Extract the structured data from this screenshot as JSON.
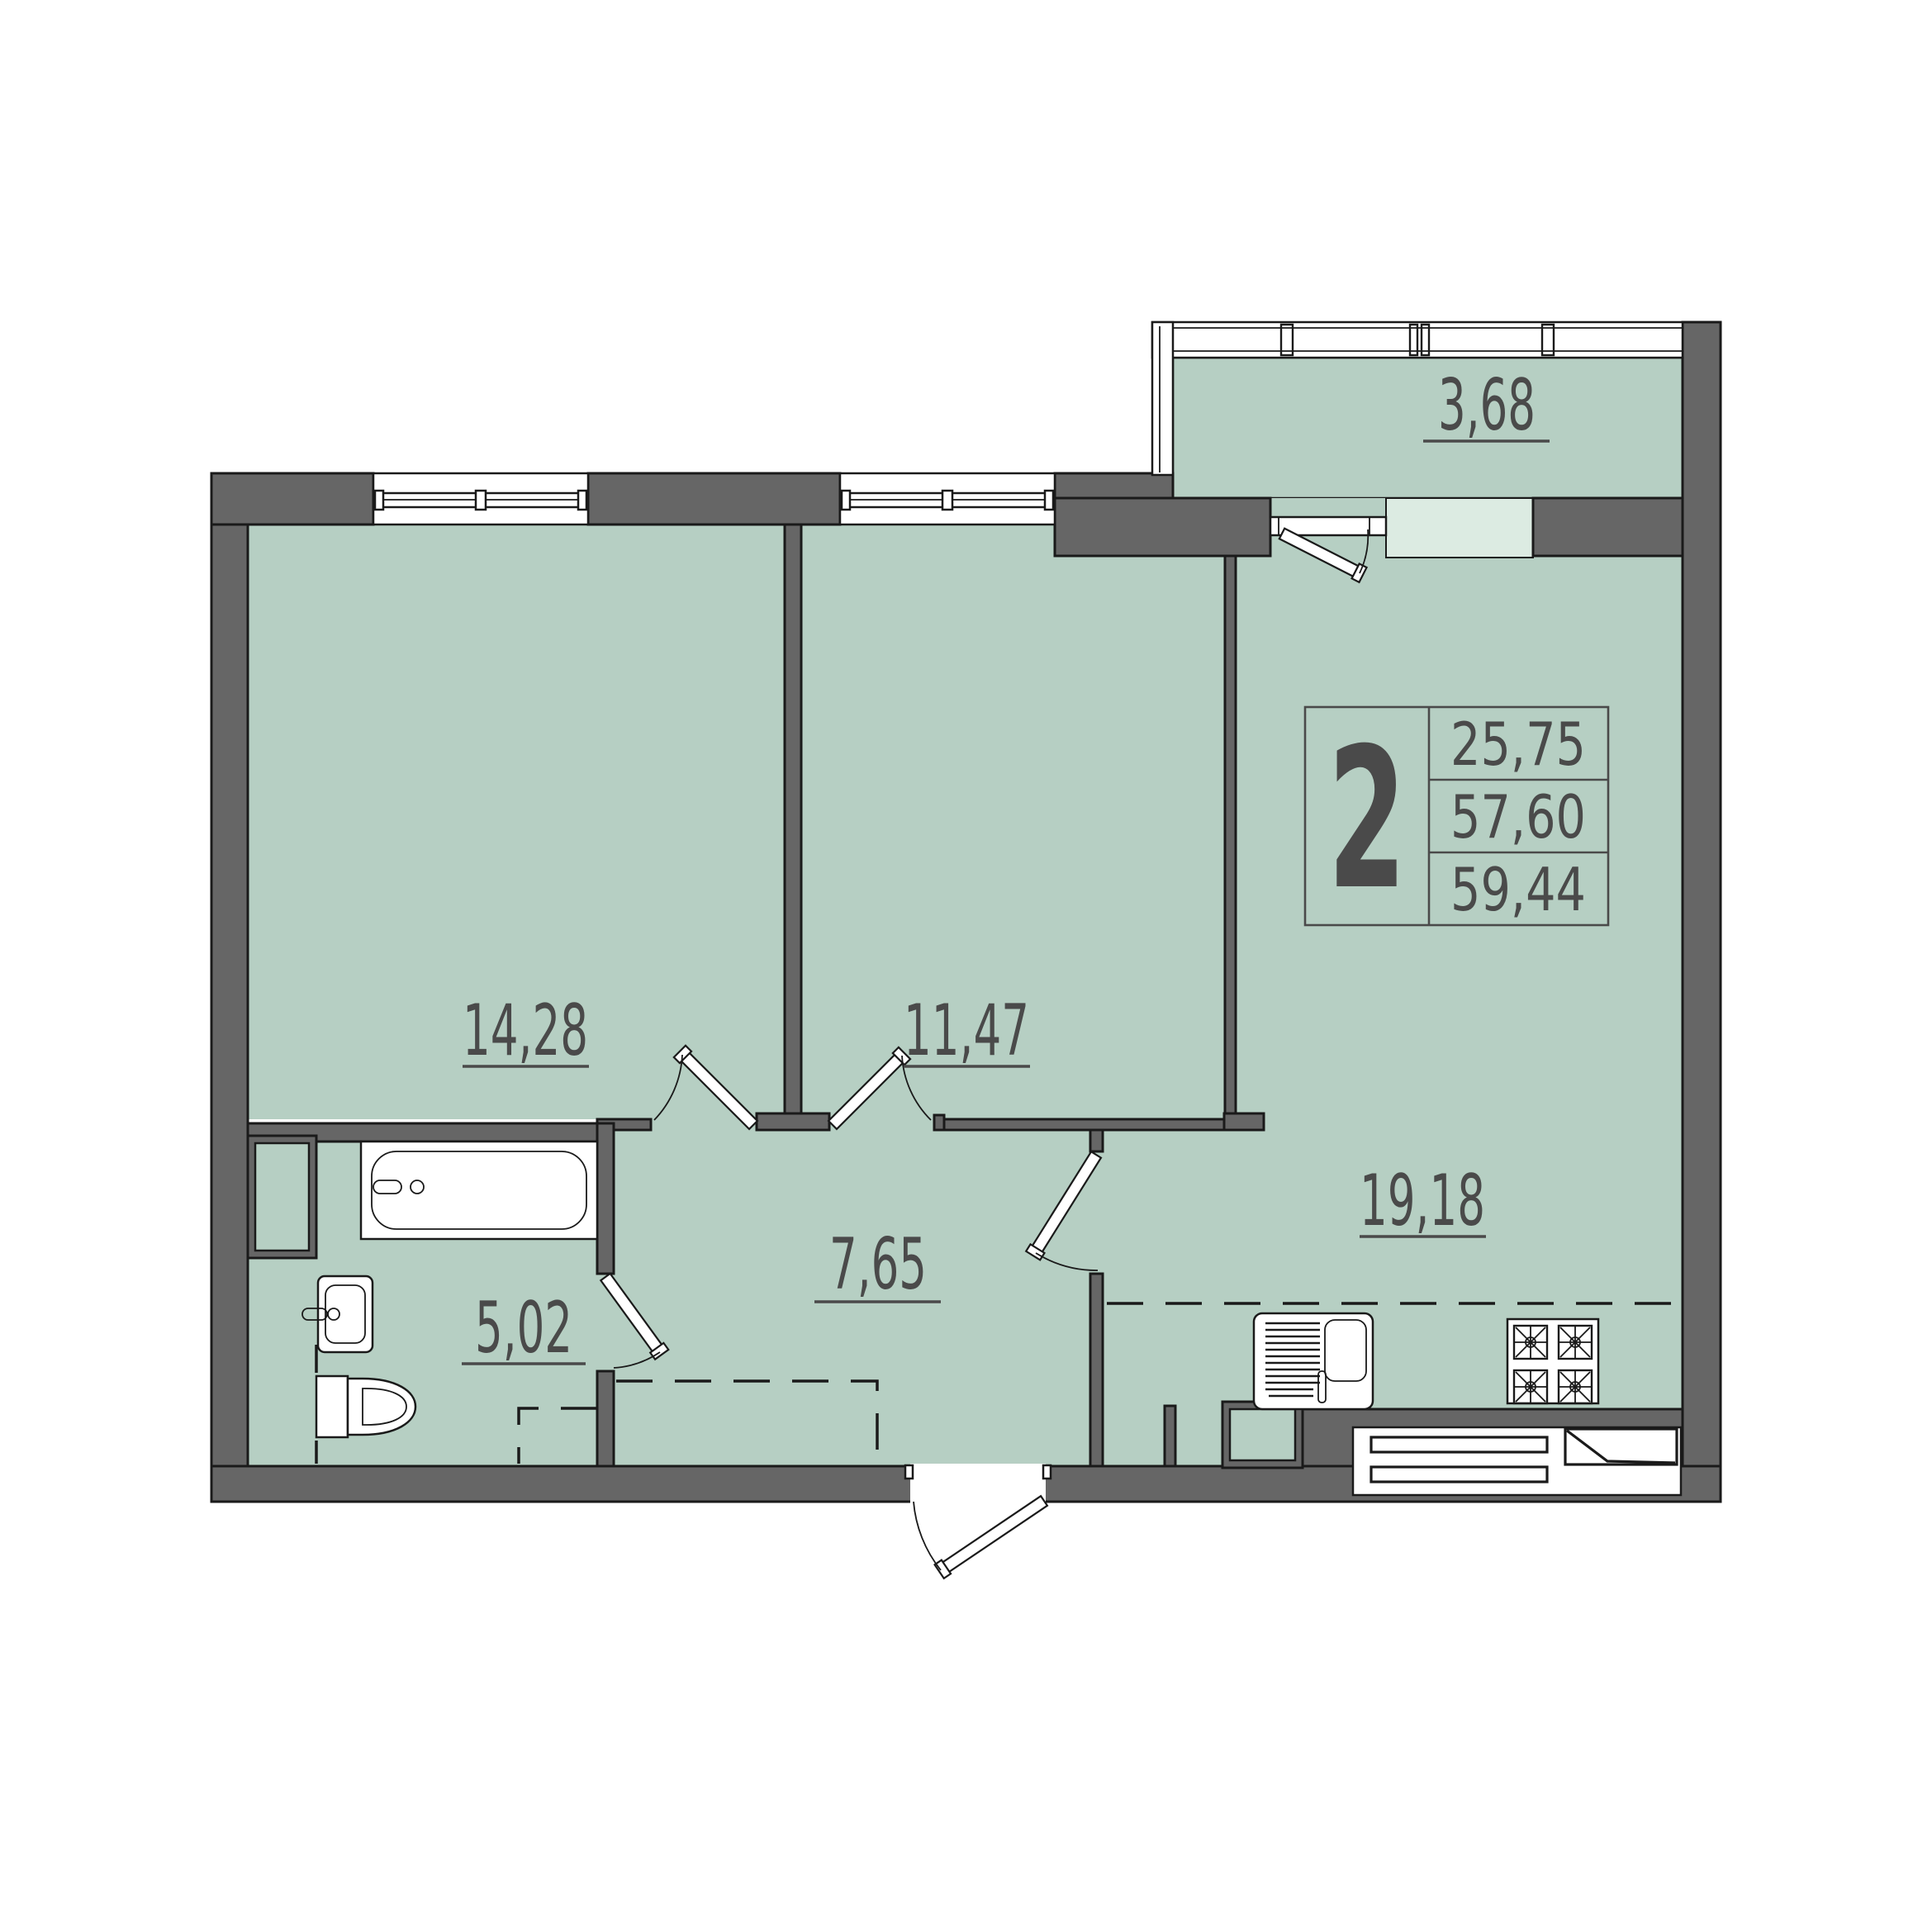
{
  "plan": {
    "type": "apartment-floor-plan",
    "rooms_in_apartment": "2",
    "colors": {
      "floor": "#b6cfc3",
      "floor_light": "#dcebe2",
      "wall": "#666666",
      "outline": "#1a1a1a",
      "label_text": "#4a4a4a",
      "background": "#ffffff"
    },
    "rooms": [
      {
        "name": "room-1",
        "area": "14,28"
      },
      {
        "name": "room-2",
        "area": "11,47"
      },
      {
        "name": "hallway",
        "area": "7,65"
      },
      {
        "name": "bathroom",
        "area": "5,02"
      },
      {
        "name": "kitchen-living",
        "area": "19,18"
      },
      {
        "name": "balcony",
        "area": "3,68"
      }
    ],
    "info_box": {
      "room_count": "2",
      "values": [
        "25,75",
        "57,60",
        "59,44"
      ]
    },
    "fixtures": [
      "bathtub",
      "washbasin",
      "toilet",
      "kitchen-sink",
      "stove-4-burner",
      "radiator-grille",
      "windows",
      "balcony-glazing",
      "doors"
    ]
  }
}
